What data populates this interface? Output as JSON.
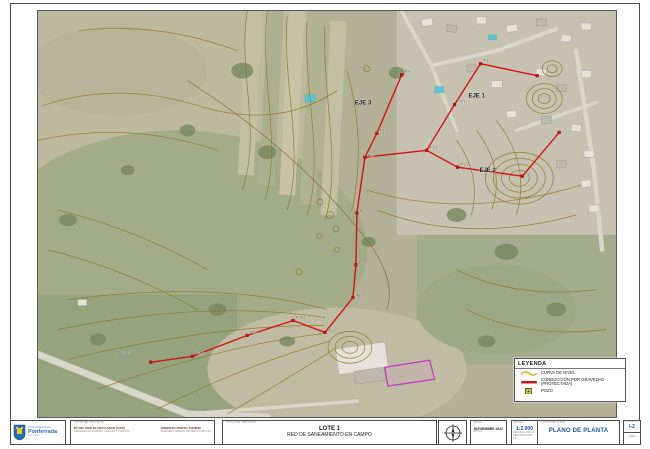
{
  "sheet": {
    "logo": {
      "org_small": "AYUNTAMIENTO DE",
      "org_name": "Ponferrada",
      "org_suffix": "es ciudad"
    },
    "authors": {
      "label": "AUTOR DEL PROYECTO:",
      "left_name": "Mª DEL MAR BLANCO ABAD (ICCP)",
      "left_title": "INGENIERA DE CAMINOS, CANALES Y PUERTOS",
      "right_name": "ROBERTO PRIETO TORIBIO",
      "right_title": "INGENIERO TÉCNICO DE OBRAS PÚBLICAS"
    },
    "project": {
      "label": "TÍTULO DEL PROYECTO",
      "line1": "LOTE 1",
      "line2": "RED DE SANEAMIENTO EN CAMPO"
    },
    "date": {
      "label": "FECHA",
      "value": "NOVIEMBRE 2022",
      "sub": "DIN A-3"
    },
    "scale": {
      "label": "ESCALA",
      "value": "1:2.000",
      "sub1": "ORIGINAL DIN-A1",
      "sub2": "REDUCIDO DIN-A3"
    },
    "plan": {
      "label": "TÍTULO DEL PLANO",
      "value": "PLANO DE PLANTA"
    },
    "number": {
      "label": "PLANO Nº",
      "value": "I-2",
      "sub": "1 de 1"
    }
  },
  "legend": {
    "title": "LEYENDA",
    "items": [
      {
        "symbol": "contour-line",
        "label": "CURVA DE NIVEL"
      },
      {
        "symbol": "gravity-pipe",
        "label": "CONDUCCIÓN POR GRAVEDAD (PROYECTADA)"
      },
      {
        "symbol": "manhole",
        "label": "POZO"
      }
    ]
  },
  "map": {
    "colors": {
      "pipe": "#d31414",
      "contour": "#8e7a22",
      "site_outline": "#c23bc2"
    },
    "eje_labels": [
      {
        "text": "EJE 1",
        "x": 432,
        "y": 87
      },
      {
        "text": "EJE 2",
        "x": 443,
        "y": 162
      },
      {
        "text": "EJE 3",
        "x": 318,
        "y": 94
      }
    ],
    "node_labels": [
      {
        "text": "P-1",
        "x": 447,
        "y": 51
      },
      {
        "text": "P-2-1",
        "x": 421,
        "y": 92
      },
      {
        "text": "P-3-1",
        "x": 393,
        "y": 138
      },
      {
        "text": "P-2-2",
        "x": 424,
        "y": 156
      },
      {
        "text": "P-2",
        "x": 489,
        "y": 165
      },
      {
        "text": "P-4",
        "x": 368,
        "y": 62
      },
      {
        "text": "P-1-1",
        "x": 343,
        "y": 121
      },
      {
        "text": "PL-1",
        "x": 331,
        "y": 146
      },
      {
        "text": "PG-1",
        "x": 323,
        "y": 202
      },
      {
        "text": "PT-2",
        "x": 322,
        "y": 254
      },
      {
        "text": "PB-1",
        "x": 319,
        "y": 287
      },
      {
        "text": "PG-2",
        "x": 291,
        "y": 322
      },
      {
        "text": "P-10-1",
        "x": 259,
        "y": 309
      },
      {
        "text": "PS-2",
        "x": 213,
        "y": 324
      },
      {
        "text": "P-1-PS",
        "x": 158,
        "y": 345
      },
      {
        "text": "P existente",
        "x": 80,
        "y": 344
      }
    ],
    "nodes": [
      {
        "x": 390,
        "y": 140
      },
      {
        "x": 418,
        "y": 94
      },
      {
        "x": 444,
        "y": 53
      },
      {
        "x": 501,
        "y": 65
      },
      {
        "x": 421,
        "y": 157
      },
      {
        "x": 486,
        "y": 166
      },
      {
        "x": 523,
        "y": 122
      },
      {
        "x": 365,
        "y": 64
      },
      {
        "x": 340,
        "y": 123
      },
      {
        "x": 328,
        "y": 147
      },
      {
        "x": 320,
        "y": 203
      },
      {
        "x": 319,
        "y": 255
      },
      {
        "x": 316,
        "y": 288
      },
      {
        "x": 288,
        "y": 323
      },
      {
        "x": 256,
        "y": 311
      },
      {
        "x": 210,
        "y": 326
      },
      {
        "x": 155,
        "y": 347
      },
      {
        "x": 113,
        "y": 353
      }
    ]
  }
}
